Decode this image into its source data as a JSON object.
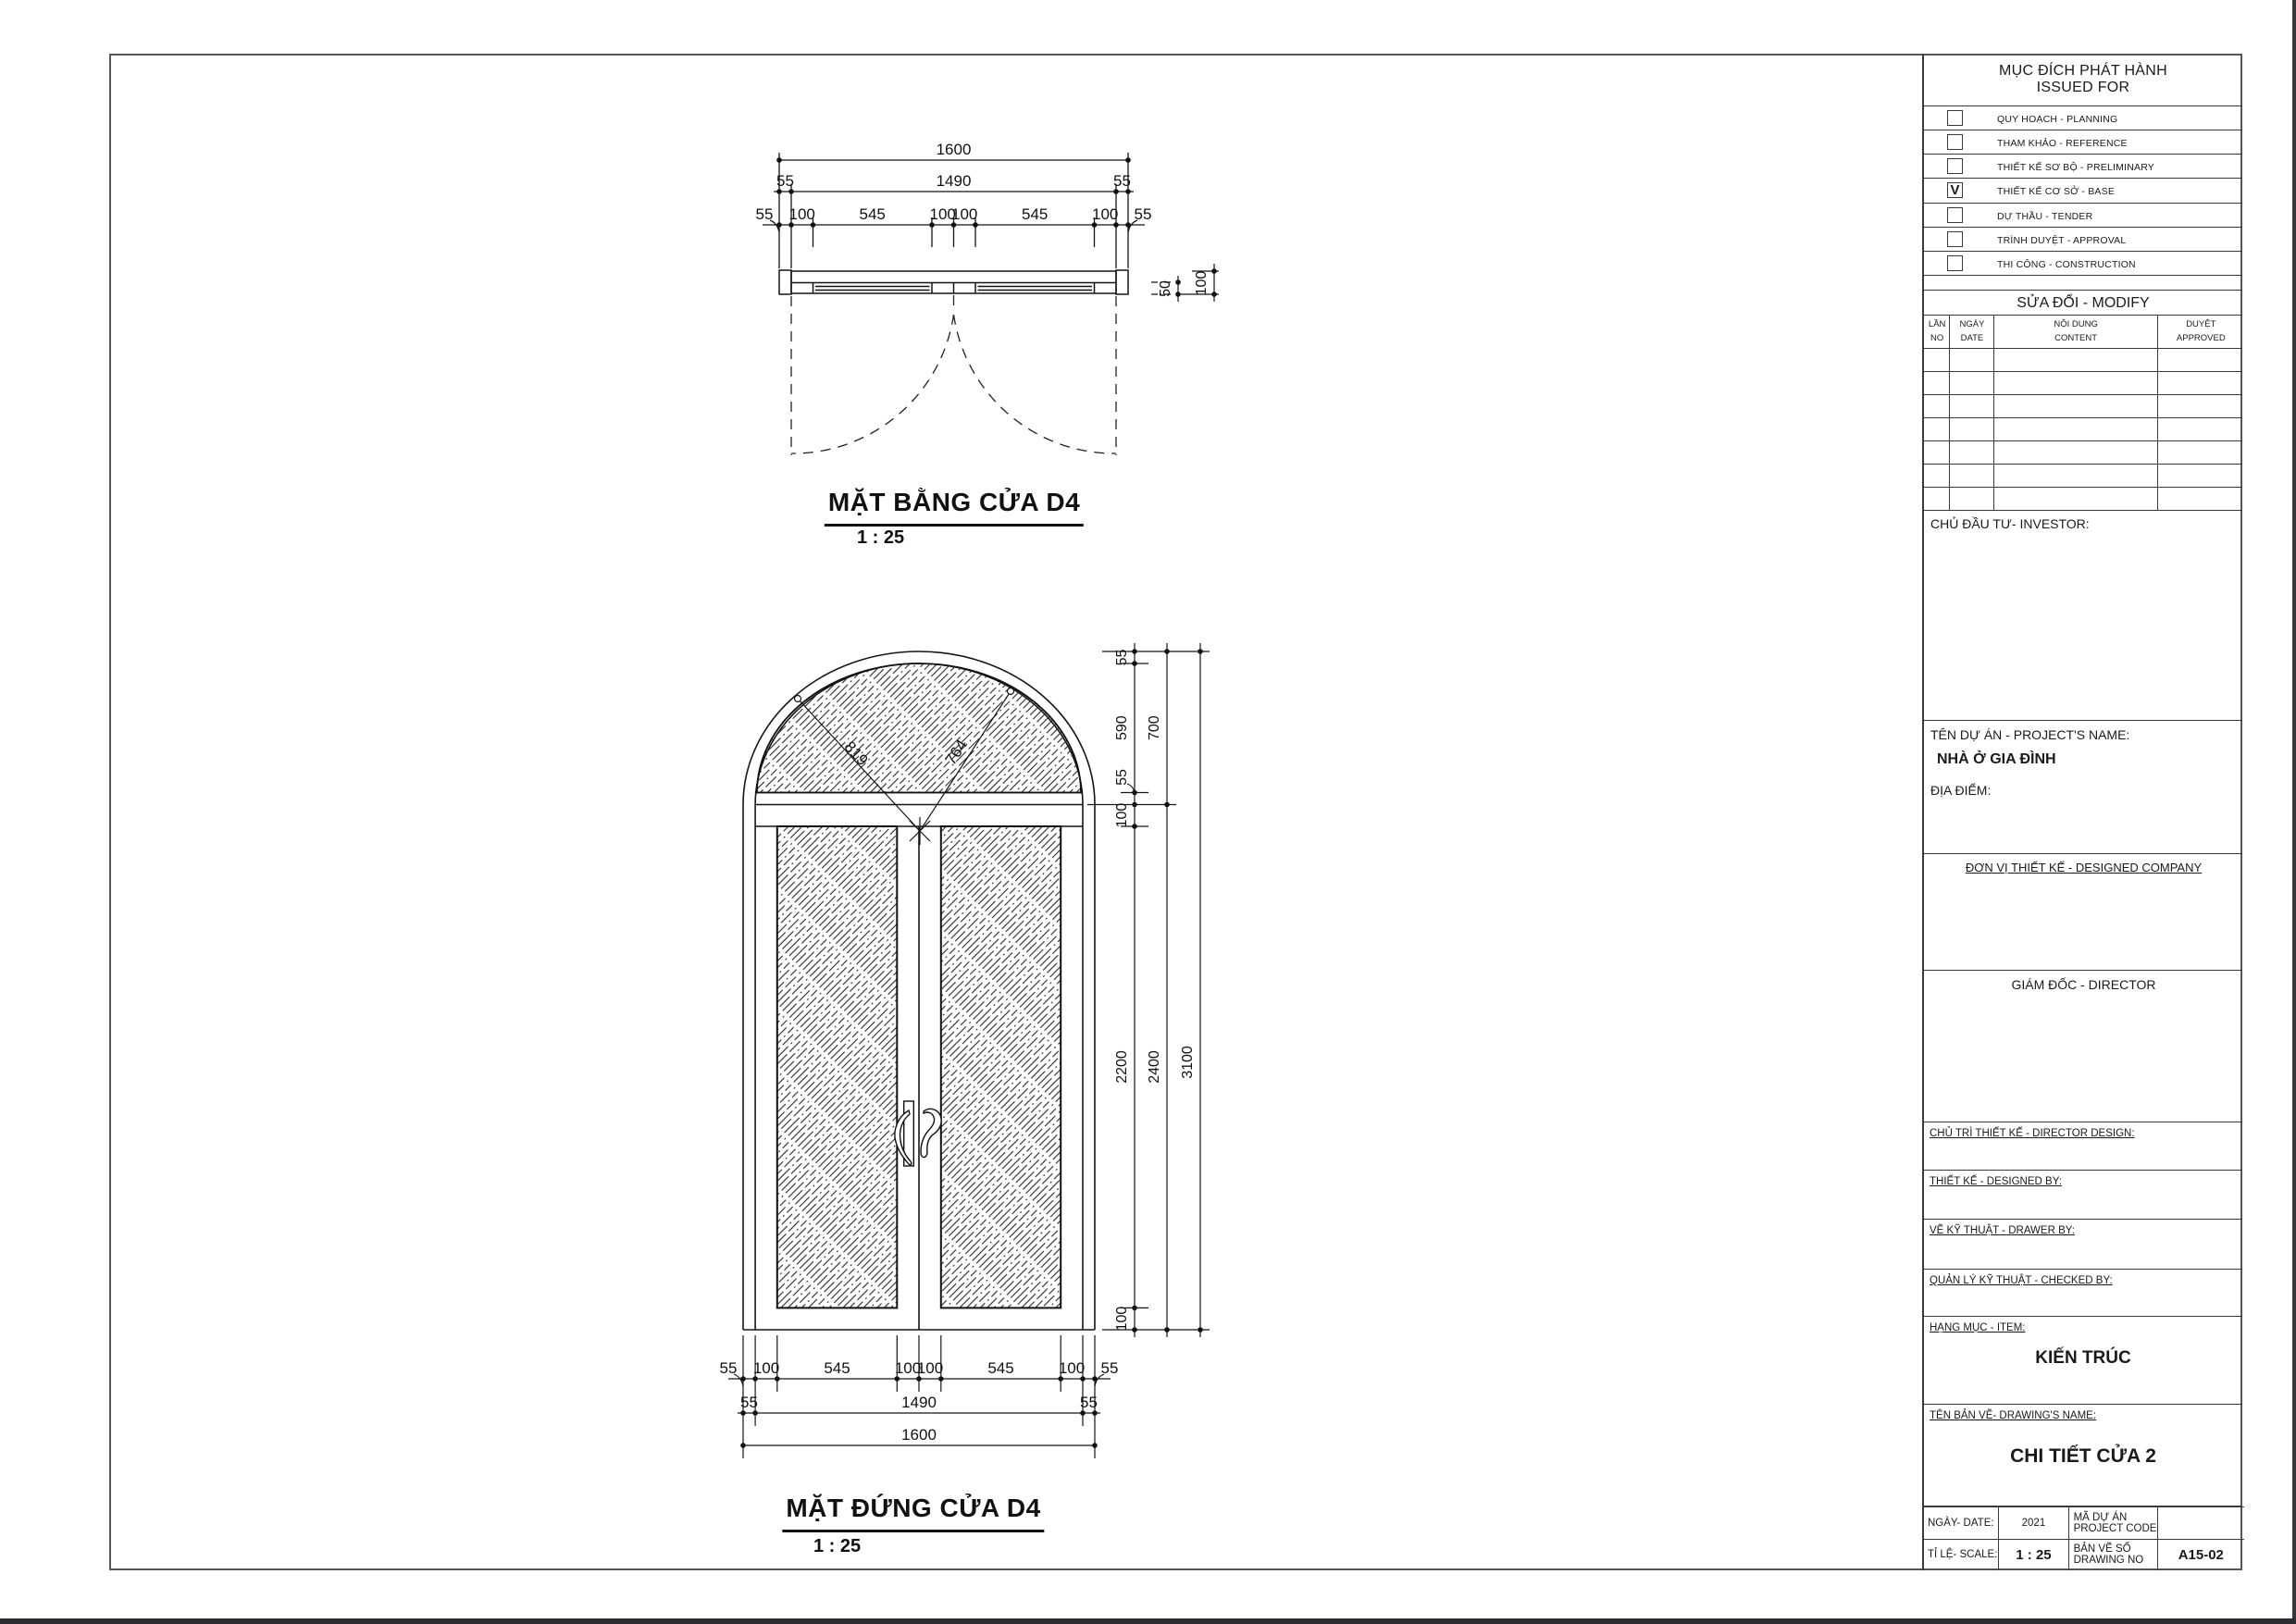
{
  "plan": {
    "title": "MẶT BẰNG CỬA D4",
    "scale_text": "1 : 25",
    "dims_top_total": "1600",
    "dims_top_mid": [
      "55",
      "1490",
      "55"
    ],
    "dims_top_detail": [
      "55",
      "100",
      "545",
      "100",
      "100",
      "545",
      "100",
      "55"
    ],
    "dims_side": [
      "50",
      "100"
    ]
  },
  "elevation": {
    "title": "MẶT ĐỨNG CỬA D4",
    "scale_text": "1 : 25",
    "dims_radius": [
      "819",
      "764"
    ],
    "dims_right_inner": [
      "55",
      "590",
      "55",
      "100",
      "2200",
      "100"
    ],
    "dims_right_mid": [
      "700",
      "2400"
    ],
    "dims_right_total": "3100",
    "dims_bottom_detail": [
      "55",
      "100",
      "545",
      "100",
      "100",
      "545",
      "100",
      "55"
    ],
    "dims_bottom_mid": [
      "55",
      "1490",
      "55"
    ],
    "dims_bottom_total": "1600"
  },
  "title_block": {
    "issued_for": {
      "title_vi": "MỤC ĐÍCH PHÁT HÀNH",
      "title_en": "ISSUED FOR",
      "check_mark": "V",
      "items": [
        {
          "label": "QUY HOẠCH - PLANNING",
          "checked": false
        },
        {
          "label": "THAM KHẢO  -  REFERENCE",
          "checked": false
        },
        {
          "label": "THIẾT KẾ SƠ BỘ  -  PRELIMINARY",
          "checked": false
        },
        {
          "label": "THIẾT KẾ CƠ SỞ  -  BASE",
          "checked": true
        },
        {
          "label": "DỰ THẦU  -  TENDER",
          "checked": false
        },
        {
          "label": "TRÌNH DUYỆT  -  APPROVAL",
          "checked": false
        },
        {
          "label": "THI CÔNG  -  CONSTRUCTION",
          "checked": false
        }
      ]
    },
    "modify": {
      "title": "SỬA ĐỔI - MODIFY",
      "columns": [
        [
          "LẦN",
          "NO"
        ],
        [
          "NGÀY",
          "DATE"
        ],
        [
          "NỘI DUNG",
          "CONTENT"
        ],
        [
          "DUYỆT",
          "APPROVED"
        ]
      ]
    },
    "investor_label": "CHỦ ĐẦU TƯ- INVESTOR:",
    "project_label": "TÊN DỰ ÁN - PROJECT'S NAME:",
    "project_name": "NHÀ Ở GIA ĐÌNH",
    "location_label": "ĐỊA ĐIỂM:",
    "company_label": "ĐƠN VỊ THIẾT KẾ - DESIGNED COMPANY",
    "director_label": "GIÁM ĐỐC - DIRECTOR",
    "director_design_label": "CHỦ TRÌ THIẾT KẾ - DIRECTOR DESIGN:",
    "designed_by_label": "THIẾT KẾ - DESIGNED BY:",
    "drawer_label": "VẼ KỸ THUẬT - DRAWER BY:",
    "checker_label": "QUẢN LÝ KỸ THUẬT - CHECKED BY:",
    "item_label": "HẠNG MỤC - ITEM:",
    "item_value": "KIẾN TRÚC",
    "drawing_name_label": "TÊN BẢN VẼ- DRAWING'S NAME:",
    "drawing_name": "CHI TIẾT CỬA 2",
    "date_label": "NGÀY- DATE:",
    "date_value": "2021",
    "project_code_label_1": "MÃ DỰ ÁN",
    "project_code_label_2": "PROJECT CODE",
    "scale_label": "TỈ LỆ- SCALE:",
    "scale_value": "1 : 25",
    "drawing_no_label_1": "BẢN VẼ SỐ",
    "drawing_no_label_2": "DRAWING NO",
    "drawing_no_value": "A15-02"
  }
}
